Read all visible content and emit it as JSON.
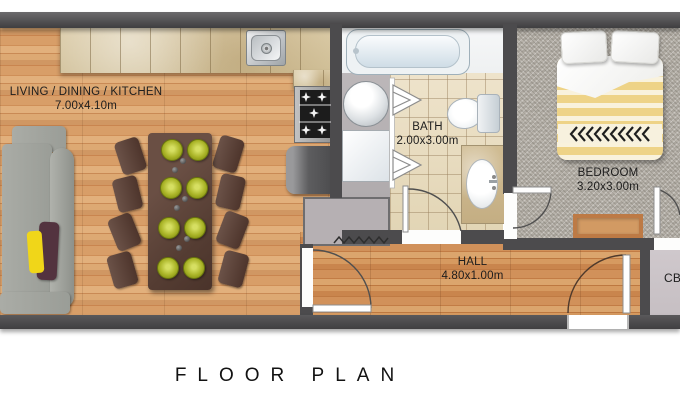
{
  "title": "FLOOR PLAN",
  "rooms": {
    "living": {
      "name": "LIVING / DINING / KITCHEN",
      "dims": "7.00x4.10m"
    },
    "bath": {
      "name": "BATH",
      "dims": "2.00x3.00m"
    },
    "bedroom": {
      "name": "BEDROOM",
      "dims": "3.20x3.00m"
    },
    "hall": {
      "name": "HALL",
      "dims": "4.80x1.00m"
    },
    "cb": {
      "name": "CB"
    }
  },
  "colors": {
    "wall": "#4c4b4d",
    "wood_floor": "#d49a64",
    "hall_floor": "#cf8f55",
    "carpet": "#b3afa7",
    "bath_tile": "#e7dcc2",
    "counter": "#d6c5a0",
    "duvet_yellow": "#eed387",
    "plate_green": "#aab427",
    "sofa_grey": "#a3a6a0",
    "table_brown": "#5a423a"
  },
  "icons": {
    "sink-icon": "square basin with round drain",
    "stove-icon": "cooktop with star burners",
    "fridge-icon": "grey box",
    "washer-icon": "circle drum",
    "bathtub-icon": "rounded tub",
    "toilet-icon": "bowl with tank",
    "wardrobe-rail-icon": "zigzag rail",
    "door-swing-icon": "quarter-circle arc",
    "folding-door-icon": "nested chevrons"
  }
}
